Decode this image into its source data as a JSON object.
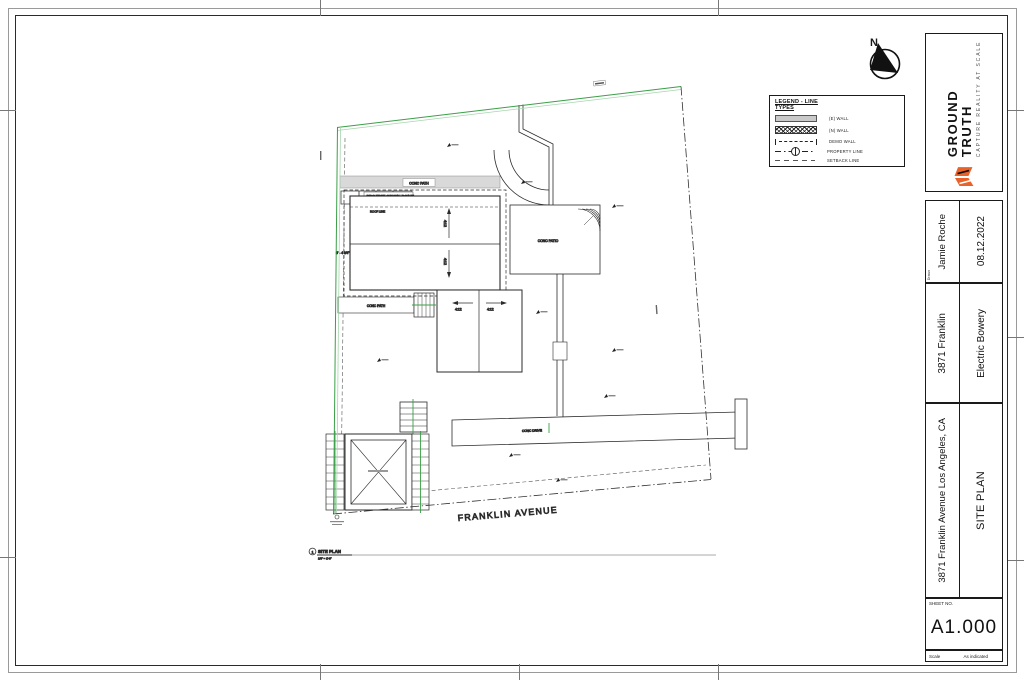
{
  "colors": {
    "property_line_green": "#3aa047",
    "property_line_green_light": "#a8d5ae",
    "brand_orange": "#e8622a"
  },
  "north_arrow": {
    "label": "N"
  },
  "legend": {
    "title_line1": "LEGEND - LINE",
    "title_line2": "TYPES",
    "items": [
      {
        "name": "existing-wall",
        "label": "(E) WALL"
      },
      {
        "name": "new-wall",
        "label": "(N) WALL"
      },
      {
        "name": "demo-wall",
        "label": "DEMO WALL"
      },
      {
        "name": "property-line",
        "label": "PROPERTY LINE"
      },
      {
        "name": "setback-line",
        "label": "SETBACK LINE"
      }
    ]
  },
  "plan": {
    "street_name": "FRANKLIN AVENUE",
    "labels": {
      "project_origin": "PROJECT ORIGIN POINT",
      "roof_line": "ROOF LINE",
      "conc_path": "CONC PATH",
      "conc_patio": "CONC PATIO",
      "conc_drive": "CONC DRIVE",
      "slope": "4:12",
      "dim_west": "3' - 4 3/4\""
    },
    "callout": {
      "number": "1",
      "title": "SITE PLAN",
      "scale": "1/8\" = 1'-0\""
    }
  },
  "titleblock": {
    "brand_name": "GROUND TRUTH",
    "brand_tagline": "CAPTURE REALITY AT SCALE",
    "drawn_label": "Drawn",
    "drawn_by": "Jamie Roche",
    "date": "08.12.2022",
    "project_name": "3871 Franklin",
    "firm_name": "Electric Bowery",
    "project_address": "3871 Franklin Avenue Los Angeles, CA",
    "sheet_title": "SITE PLAN",
    "sheet_no_label": "SHEET NO.",
    "sheet_number": "A1.000",
    "scale_label": "Scale",
    "scale_value": "As indicated"
  }
}
